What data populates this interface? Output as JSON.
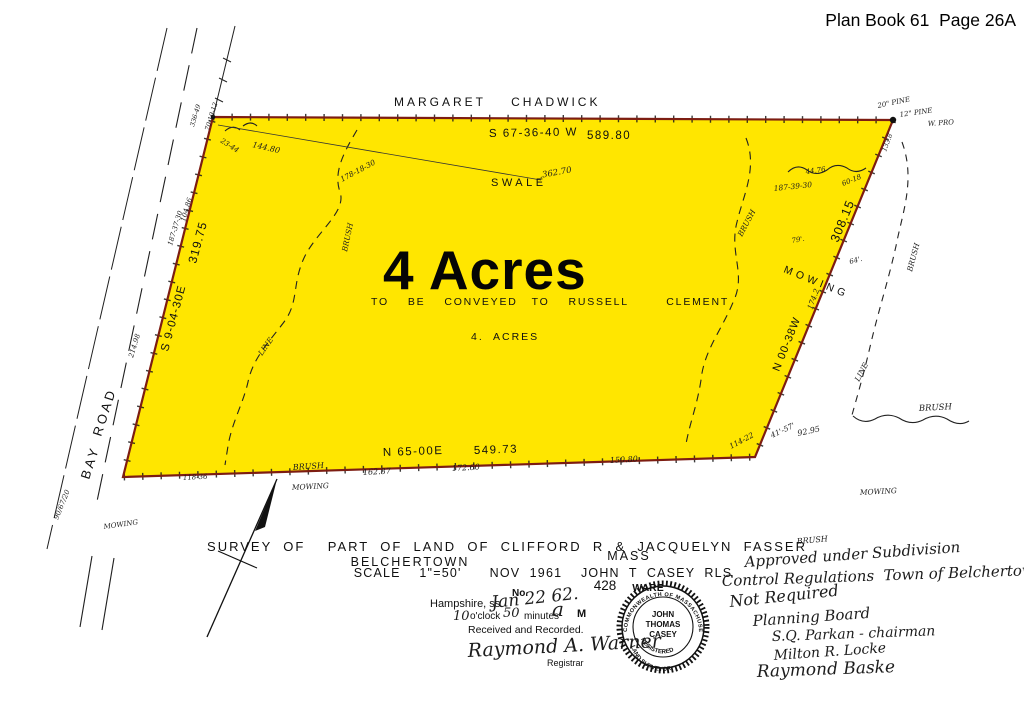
{
  "header": {
    "plan_book": "Plan Book 61  Page 26A"
  },
  "abutter": {
    "north": "MARGARET    CHADWICK"
  },
  "parcel": {
    "area_big": "4 Acres",
    "conveyed": "TO    BE    CONVEYED   TO    RUSSELL        CLEMENT",
    "area_small": "4.  ACRES",
    "swale": "SWALE"
  },
  "bearings": {
    "north_bearing": "S 67-36-40 W",
    "north_distance": "589.80",
    "west_bearing": "S 9-04-30E",
    "west_distance": "319.75",
    "south_bearing": "N 65-00E",
    "south_distance": "549.73",
    "east_bearing": "N 00-38W",
    "east_distance": "308.15",
    "east_mowing": "MOWING"
  },
  "road": {
    "name_top": "ROAD",
    "name_bottom": "BAY"
  },
  "hw": {
    "tie_362": ".362.70",
    "angle_178": "178-18-30",
    "dist_144": "144.80",
    "angle_23": "23-44",
    "angle_336": "336-49",
    "angle_70": "70-19-12",
    "pine20": "20\" PINE",
    "pine12": "12\" PINE",
    "wpro": "W. PRO",
    "dist_133": "133.8",
    "angle_187_39": "187-39-30",
    "dist_44": "44.76",
    "angle_60": "60-18",
    "d79": "79'.",
    "d64": "64'.",
    "dist_174": "174.2",
    "brush_right_curve": "BRUSH",
    "brush_outer": "BRUSH",
    "line_outer": "LINE",
    "brush_outer_h": "BRUSH",
    "brush_left_curve": "BRUSH",
    "line_left_curve": "LINE",
    "angle_114": "114-22",
    "d41": "41'-57'",
    "dist_92": "92.95",
    "mowing_right": "MOWING",
    "mowing_bottom": "MOWING",
    "mowing_road": "MOWING",
    "brush_bottom": "BRUSH",
    "dist_162": "162.87",
    "dist_172": "172.60",
    "dist_150": "150.80",
    "dist_118": "118-36",
    "angle_187_37": "187-37-30",
    "dist_104": "104.86",
    "dist_214": "214.98",
    "road_note": "90/67/20"
  },
  "title_block": {
    "line1": "SURVEY  OF    PART  OF  LAND  OF  CLIFFORD  R  &  JACQUELYN  FASSER",
    "town": "BELCHERTOWN",
    "state": "MASS",
    "scale_line": "SCALE    1\"=50'      NOV  1961    JOHN  T  CASEY  RLS",
    "ware": "WARE",
    "number": "428"
  },
  "recording": {
    "county": "Hampshire, ss.",
    "no_label": "No.",
    "date_hw": "Jan 22 62.",
    "hour_hw": "10",
    "oclock": "o'clock",
    "minutes_hw": "50",
    "minutes_label": "minutes",
    "am_hw": "a",
    "m_label": "M",
    "received": "Received and Recorded.",
    "registrar_sig": "Raymond A. Warner",
    "registrar_label": "Registrar"
  },
  "seal": {
    "top": "COMMONWEALTH OF MASSACHUSETTS",
    "name1": "JOHN",
    "name2": "THOMAS",
    "name3": "CASEY",
    "mid": "REGISTERED",
    "bottom": "LAND SURVEYOR"
  },
  "approval": {
    "brush": "BRUSH",
    "line1": "Approved under Subdivision",
    "line2": "Control Regulations  Town of Belchertown",
    "line3": "Not Required",
    "line4": "Planning Board",
    "line5": "S.Q. Parkan - chairman",
    "line6": "Milton R. Locke",
    "line7": "Raymond Baske"
  },
  "colors": {
    "parcel_fill": "#ffe600",
    "boundary": "#7d1d12",
    "ink": "#111111"
  }
}
